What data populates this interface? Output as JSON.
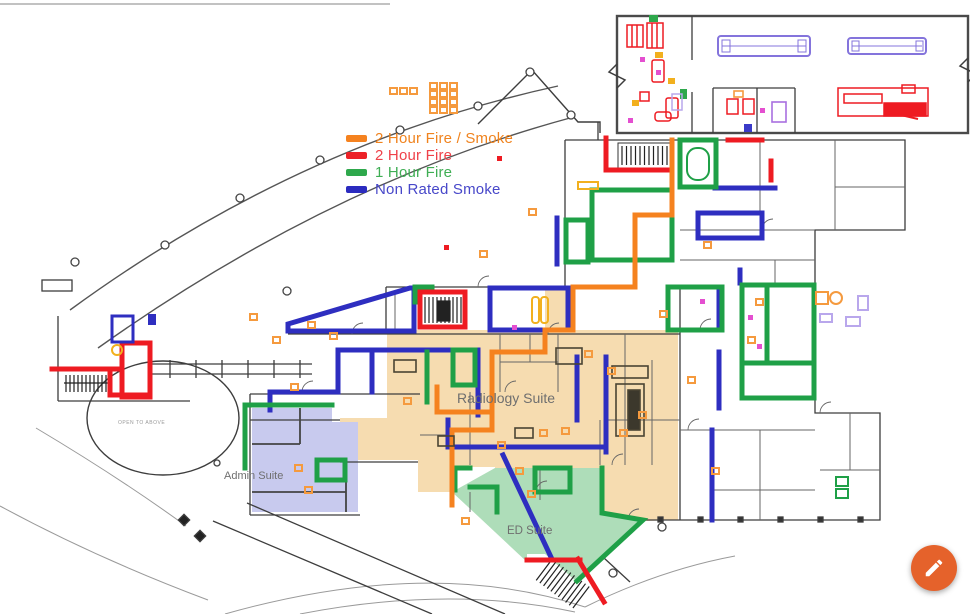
{
  "legend": {
    "items": [
      {
        "id": "two-hour-fire-smoke",
        "label": "2 Hour Fire / Smoke",
        "swatch_color": "#F5821F",
        "text_color": "#F0831E"
      },
      {
        "id": "two-hour-fire",
        "label": "2 Hour Fire",
        "swatch_color": "#EC2228",
        "text_color": "#EF4149"
      },
      {
        "id": "one-hour-fire",
        "label": "1 Hour Fire",
        "swatch_color": "#2EA84C",
        "text_color": "#3FAE54"
      },
      {
        "id": "non-rated-smoke",
        "label": "Non Rated Smoke",
        "swatch_color": "#2B2BBF",
        "text_color": "#4747C9"
      }
    ]
  },
  "plan": {
    "suite_labels": {
      "radiology": "Radiology Suite",
      "admin": "Admin Suite",
      "ed": "ED Suite"
    },
    "notes": {
      "open_to_above": "OPEN TO ABOVE"
    },
    "barrier_colors": {
      "two_hour_fire_smoke": "#F5821F",
      "two_hour_fire": "#EE1B22",
      "one_hour_fire": "#1FA047",
      "non_rated_smoke": "#2E2EC0"
    },
    "fill_colors": {
      "radiology_suite": "#F6DCB0",
      "admin_suite": "#C8CAEE",
      "ed_suite": "#AEDDB9"
    },
    "marker_colors": {
      "extinguisher_orange": "#F59A3E",
      "equipment_yellow": "#F2B01E",
      "equipment_magenta": "#E44FD0",
      "equipment_purple": "#B9A7EC",
      "ahu_purple": "#8474DC"
    },
    "label_color": "#6f6f6f"
  },
  "fab": {
    "name": "edit",
    "icon": "pencil-icon",
    "color": "#E5622B"
  }
}
